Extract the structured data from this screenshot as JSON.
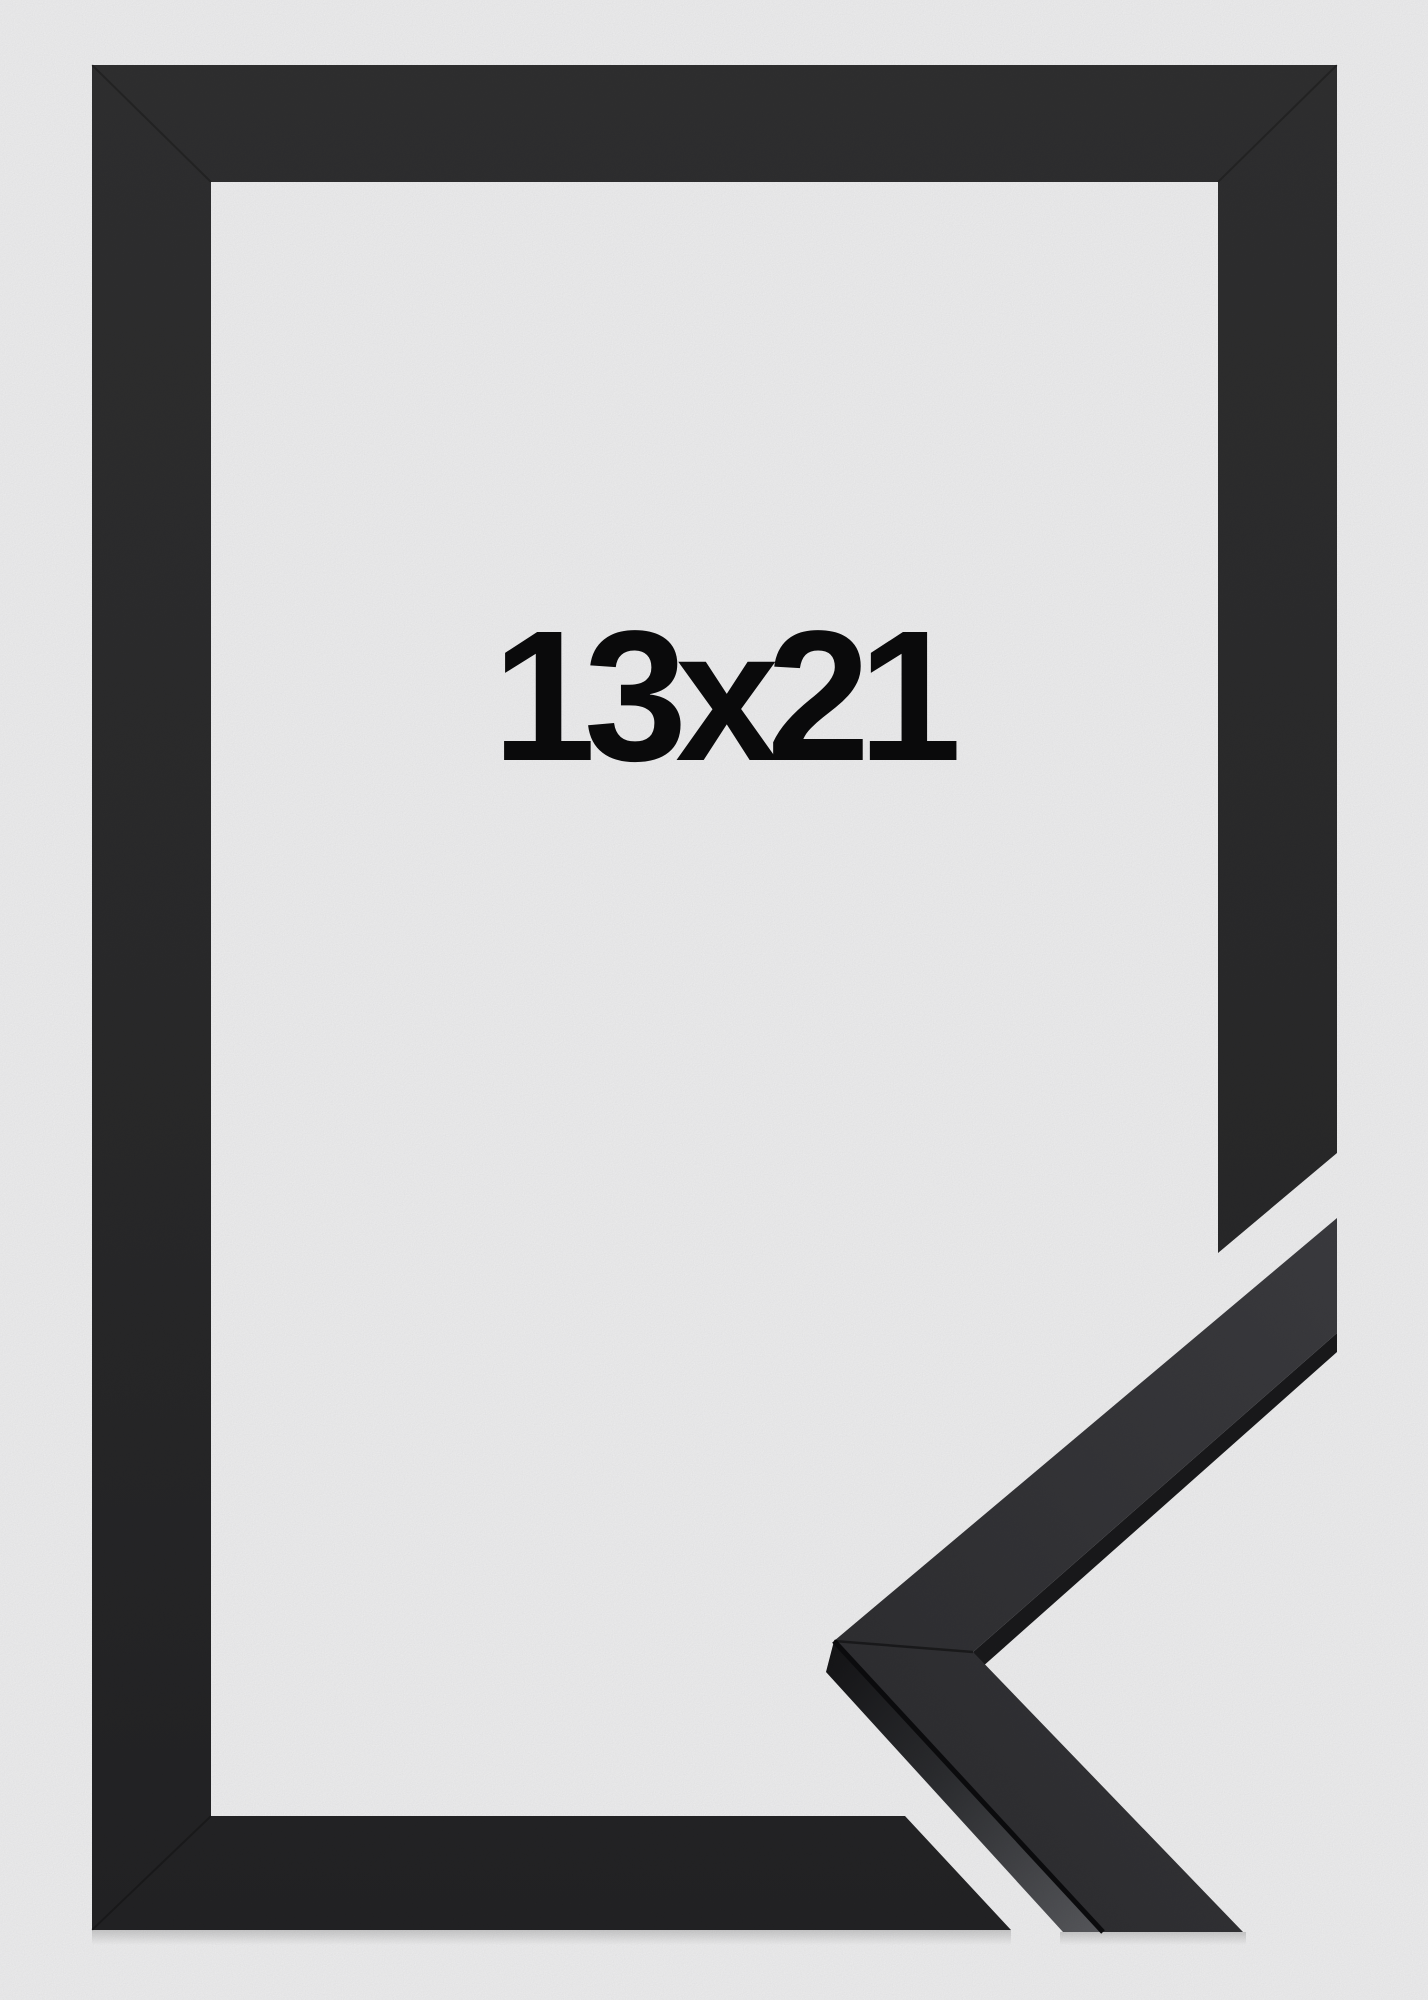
{
  "photo": {
    "size_label": "13x21",
    "colors": {
      "background": "#f1f1f2",
      "frame_face_top": "#303031",
      "frame_face_bottom": "#232325",
      "sample_face_light": "#3c3c40",
      "sample_face_dark": "#2d2d30",
      "sample_edge_dark": "#1a1a1c",
      "sample_side_shadow": "#141416",
      "sample_side_lit": "#595a5e",
      "label_text": "#0b0b0c"
    }
  }
}
